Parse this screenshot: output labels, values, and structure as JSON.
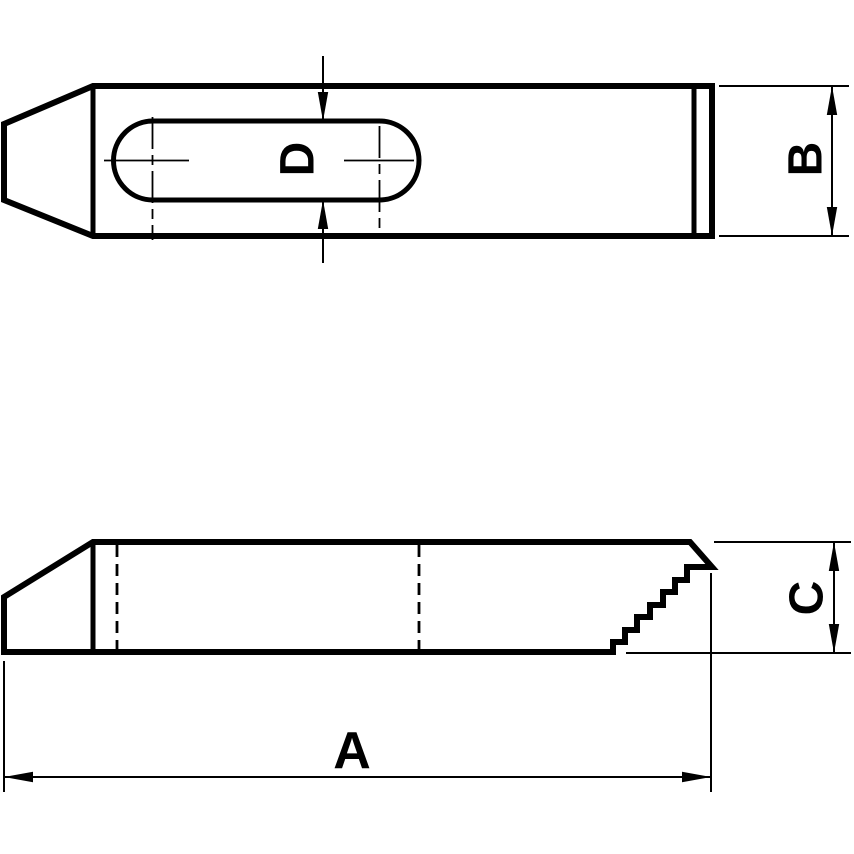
{
  "drawing": {
    "dimensions": {
      "overall_length": "A",
      "body_width": "B",
      "body_height": "C",
      "slot_width": "D"
    },
    "colors": {
      "line": "#000000",
      "background": "#ffffff"
    }
  }
}
